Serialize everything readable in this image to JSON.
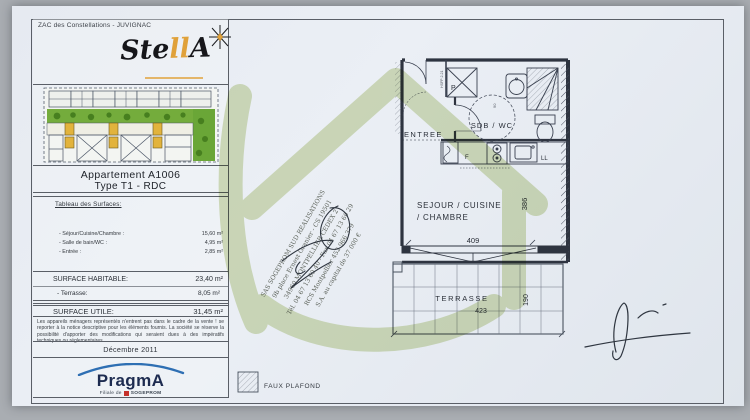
{
  "header": {
    "project": "ZAC des Constellations - JUVIGNAC",
    "brand": {
      "name_start": "Ste",
      "name_mid": "ll",
      "name_end": "A"
    }
  },
  "titleblock": {
    "apartment_title": "Appartement A1006",
    "apartment_subtitle": "Type T1 - RDC",
    "surfaces_heading": "Tableau des Surfaces:",
    "surfaces": {
      "items": [
        {
          "label": "- Séjour/Cuisine/Chambre :",
          "value": "15,60 m²"
        },
        {
          "label": "- Salle de bain/WC :",
          "value": "4,95 m²"
        },
        {
          "label": "- Entrée :",
          "value": "2,85 m²"
        }
      ],
      "habitable_label": "SURFACE HABITABLE:",
      "habitable_value": "23,40 m²",
      "terrasse_label": "- Terrasse:",
      "terrasse_value": "8,05 m²",
      "utile_label": "SURFACE UTILE:",
      "utile_value": "31,45 m²"
    },
    "disclaimer": "Les appareils ménagers représentés n'entrent pas dans le cadre de la vente ! se reporter à la notice descriptive pour les éléments fournis. La société se réserve la possibilité d'apporter des modifications qui seraient dues à des impératifs techniques ou réglementaires.",
    "date": "Décembre 2011",
    "developer": {
      "name": "PragmA",
      "tagline_prefix": "Filiale de",
      "tagline_brand": "SOGEPROM"
    }
  },
  "plan": {
    "rooms": {
      "entree": "ENTREE",
      "sdb": "SDB / WC",
      "sejour_line1": "SEJOUR / CUISINE",
      "sejour_line2": "/ CHAMBRE",
      "terrasse": "TERRASSE"
    },
    "labels": {
      "placard": "P",
      "frigo": "F",
      "lave_linge": "LL"
    },
    "dimensions": {
      "sejour_width": "409",
      "sejour_height": "386",
      "terrasse_width": "423",
      "terrasse_height": "190"
    },
    "annotations": {
      "ceiling": "HSFP 2.21",
      "door_width": "90"
    },
    "legend": {
      "faux_plafond": "FAUX PLAFOND"
    }
  },
  "stamp": {
    "lines": [
      "SAS SOGEPROM SUD REALISATIONS",
      "9b place Ernest Granier - CS 19501",
      "34960 MONTPELLIER CEDEX 2",
      "Tél. 04 67 13 60 40 - Fax 04 67 13 60 29",
      "RCS Montpellier 452 966 379",
      "S.A. au capital de 37 000 €"
    ]
  },
  "colors": {
    "accent_orange": "#e0a13a",
    "watermark_green": "#b5c87f",
    "pragma_blue": "#2e6fb3",
    "pragma_navy": "#1d2b50",
    "sogeprom_red": "#c5312b",
    "site_green": "#74ac3c",
    "site_yellow": "#e2b33c",
    "line_ink": "#2e3440"
  }
}
